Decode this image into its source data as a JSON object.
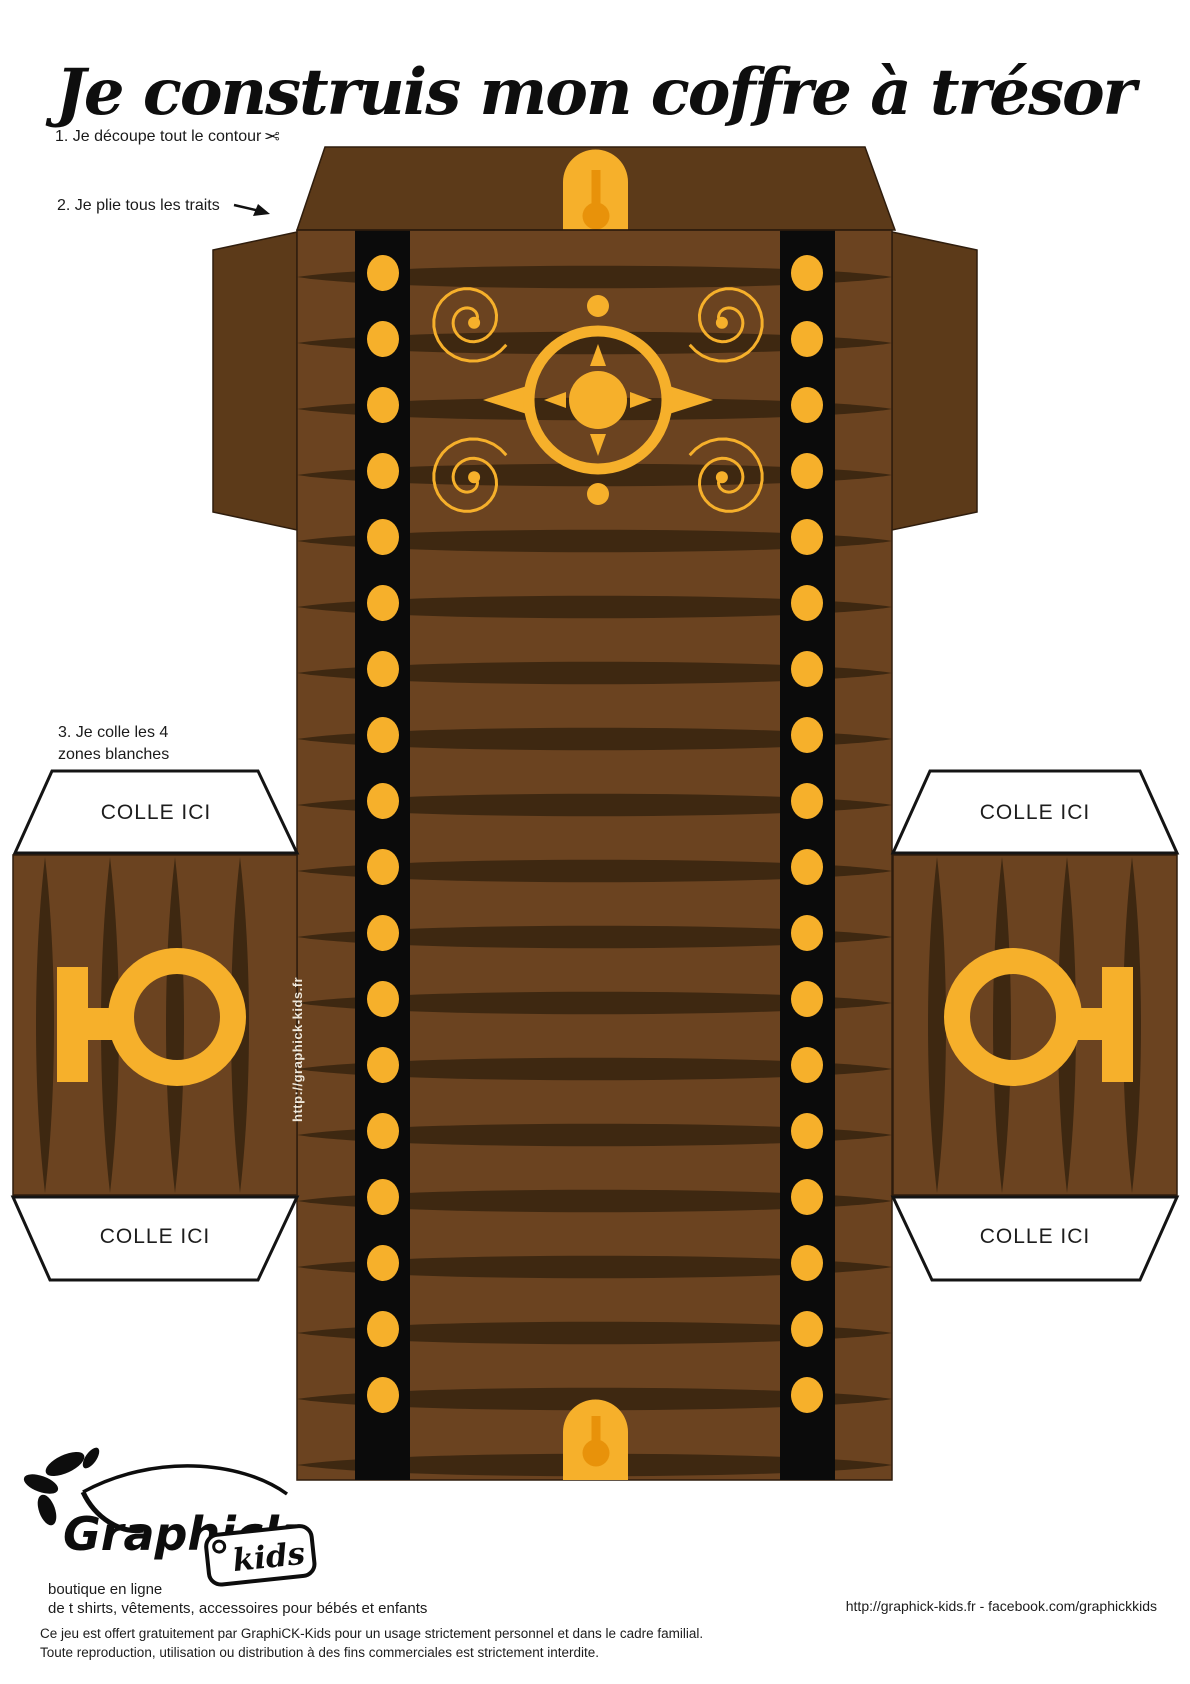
{
  "title": "Je construis mon coffre à trésor",
  "instructions": {
    "step1": "1. Je découpe tout le contour",
    "scissors_icon": "✂",
    "step2": "2. Je plie tous les traits",
    "step3_line1": "3. Je colle les 4",
    "step3_line2": "zones blanches"
  },
  "template": {
    "glue_label": "COLLE ICI",
    "side_url": "http://graphick-kids.fr"
  },
  "footer": {
    "logo_text": "Graphick",
    "logo_sub": "kids",
    "boutique_line1": "boutique en ligne",
    "boutique_line2": "de t shirts, vêtements, accessoires pour bébés et enfants",
    "links": "http://graphick-kids.fr - facebook.com/graphickkids",
    "legal_line1": "Ce jeu est offert gratuitement par GraphiCK-Kids pour un usage strictement personnel et dans le cadre familial.",
    "legal_line2": "Toute reproduction, utilisation ou distribution à des fins commerciales est strictement interdite."
  },
  "colors": {
    "gold": "#F6B02B",
    "gold-deep": "#E8920A",
    "body-brown": "#6B4320",
    "dark-brown": "#3E2811",
    "lid-brown": "#5C3A19",
    "strap-black": "#0B0B0B",
    "outline": "#2F1D0D",
    "ink": "#1C1C1C",
    "url-cream": "#EFE8DB"
  }
}
